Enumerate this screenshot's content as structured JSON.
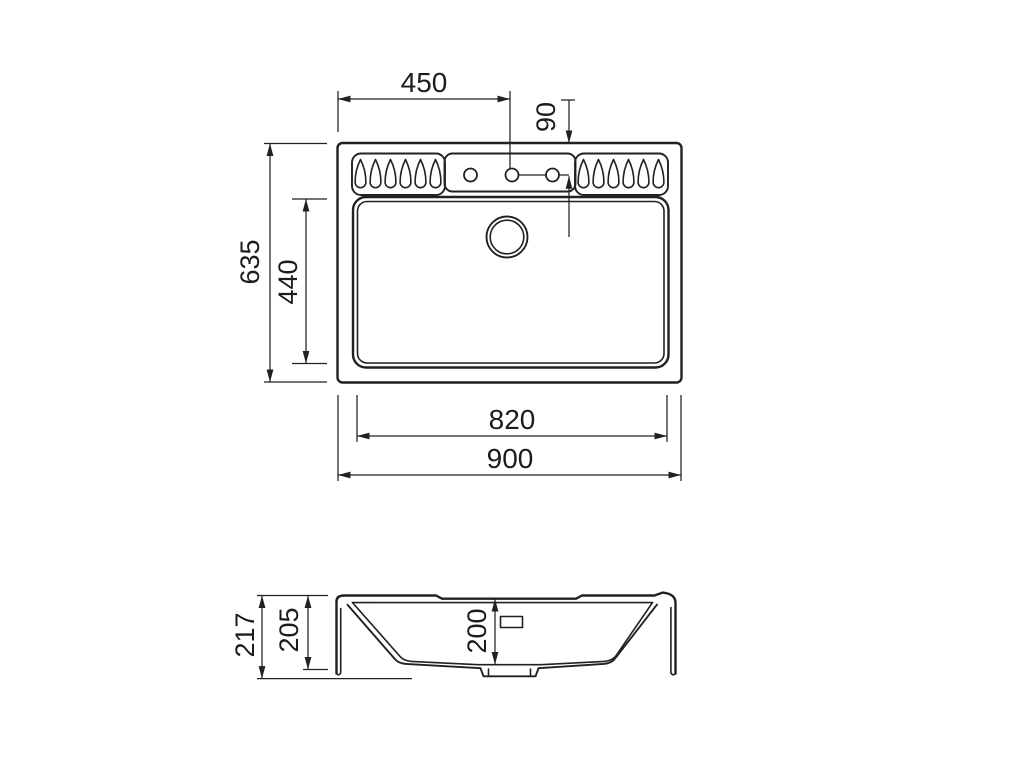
{
  "drawing": {
    "background_color": "#ffffff",
    "line_color": "#212121",
    "views": {
      "top": {
        "dimensions": {
          "tap_hole_center_from_left": "450",
          "tap_hole_center_from_top_edge": "90",
          "overall_depth": "635",
          "bowl_depth": "440",
          "bowl_width": "820",
          "overall_width": "900"
        },
        "features": {
          "tap_holes": 3,
          "drainer_grooves_left": 6,
          "drainer_grooves_right": 6,
          "waste_holes": 1
        }
      },
      "section": {
        "dimensions": {
          "overall_height": "217",
          "height_to_flange_bottom": "205",
          "bowl_inner_depth": "200"
        },
        "features": {
          "overflow_slots": 1,
          "mounting_hooks": 2
        }
      }
    }
  }
}
